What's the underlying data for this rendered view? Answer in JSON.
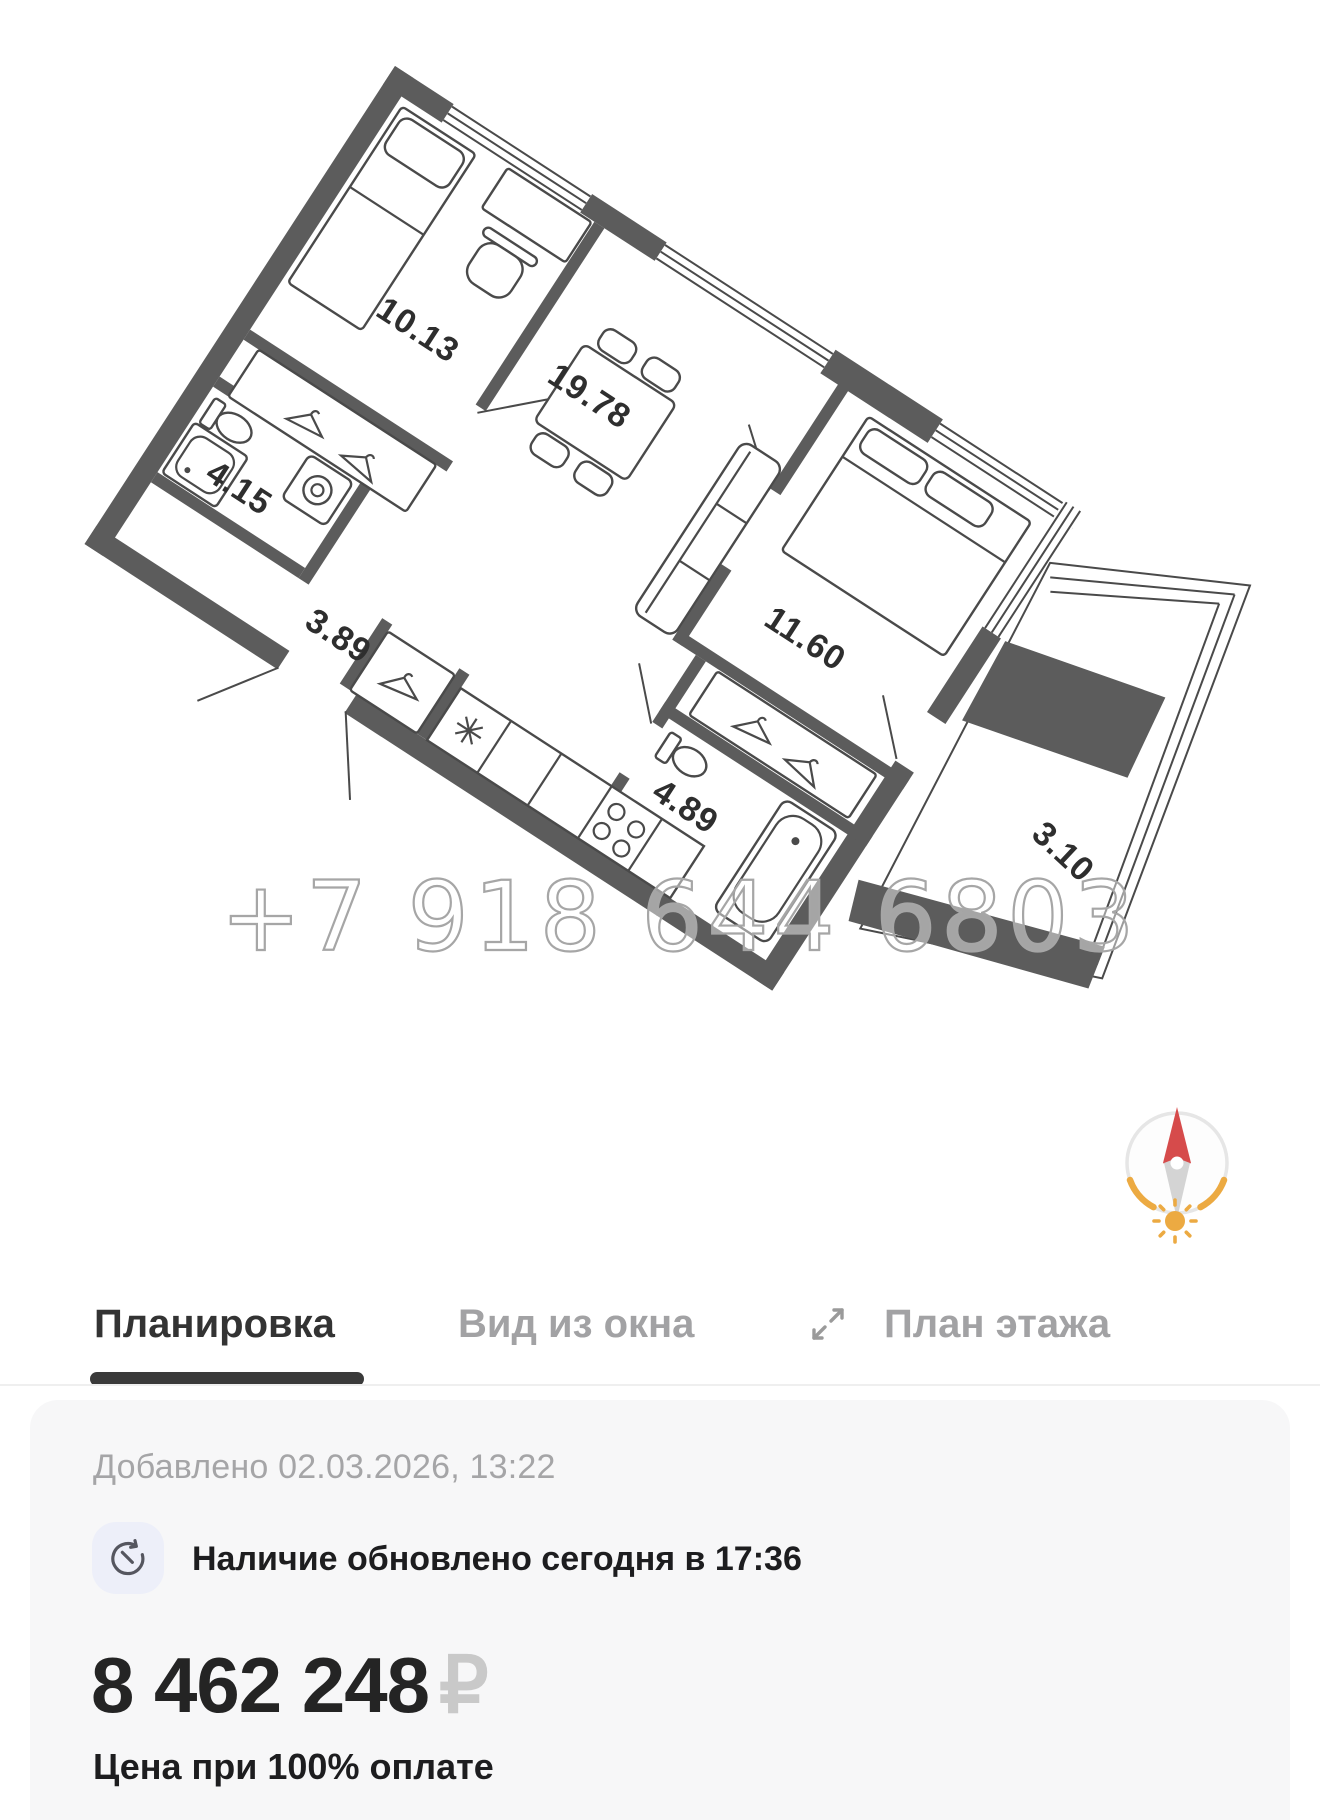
{
  "floor_plan": {
    "watermark_phone": "+7 918 644 6803",
    "areas": {
      "kids_room": "10.13",
      "living_kitchen": "19.78",
      "bathroom_left": "4.15",
      "hallway": "3.89",
      "bedroom": "11.60",
      "bathroom_right": "4.89",
      "balcony": "3.10"
    },
    "colors": {
      "wall": "#5c5c5c",
      "compass_north": "#d64b4b",
      "compass_arc": "#ecaa42"
    }
  },
  "tabs": {
    "items": [
      {
        "label": "Планировка",
        "active": true
      },
      {
        "label": "Вид из окна",
        "active": false
      },
      {
        "label": "План этажа",
        "active": false,
        "icon": "expand-icon"
      }
    ]
  },
  "listing": {
    "added_text": "Добавлено 02.03.2026, 13:22",
    "availability_text": "Наличие обновлено сегодня в 17:36",
    "price": "8 462 248",
    "currency": "₽",
    "price_note": "Цена при 100% оплате"
  }
}
